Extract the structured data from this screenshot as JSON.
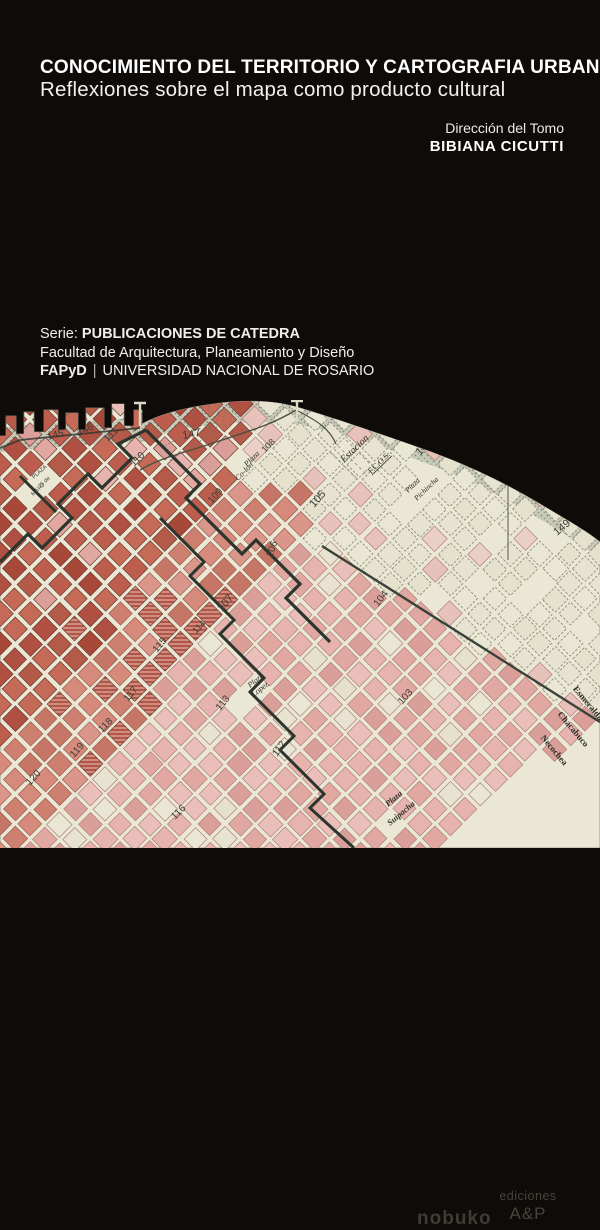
{
  "cover": {
    "title": "CONOCIMIENTO DEL TERRITORIO Y CARTOGRAFIA URBANA",
    "subtitle": "Reflexiones sobre el mapa como producto cultural",
    "direction_label": "Dirección del Tomo",
    "director_name": "BIBIANA CICUTTI",
    "series_prefix": "Serie:",
    "series_name": "PUBLICACIONES DE CATEDRA",
    "faculty": "Facultad de Arquitectura, Planeamiento y Diseño",
    "institution_abbr": "FAPyD",
    "institution_sep": "|",
    "institution_name": "UNIVERSIDAD NACIONAL DE ROSARIO"
  },
  "publisher": {
    "name": "nobuko",
    "imprint_line1": "ediciones",
    "imprint_line2": "A&P"
  },
  "map": {
    "description": "historic cadastral plan of Rosario with river coastline, pink block grid and numbered sections",
    "palette": {
      "paper": "#ebe7d5",
      "coast_band": "#c7cab8",
      "coast_dots": "#68725f",
      "bold_line": "#2c352d",
      "label_ink": "#3c3c33",
      "serif_ink": "#2e2e27",
      "dark": [
        "#b05042",
        "#bd5d4e",
        "#a84838",
        "#c46a57",
        "#b45a48"
      ],
      "salmon": [
        "#cd7f70",
        "#d58a7b",
        "#c67666",
        "#da968a"
      ],
      "light": [
        "#e1a8a2",
        "#e6b3ae",
        "#db9f99",
        "#eabfb9"
      ],
      "pale_pink": [
        "#e9cfc6",
        "#e6c2ba"
      ],
      "cream": [
        "#e7e3d0",
        "#eae6d4",
        "#e5e1cd"
      ],
      "stroke_dark": "#6e3a30",
      "stroke_salmon": "#9c5c4e",
      "stroke_light": "#b07f78",
      "stroke_dashed": "#8f8d7c"
    },
    "labels": [
      {
        "t": "145",
        "x": 48,
        "y": 40,
        "r": -15,
        "s": 10
      },
      {
        "t": "146",
        "x": 79,
        "y": 36,
        "r": -26,
        "s": 10
      },
      {
        "t": "147",
        "x": 183,
        "y": 39,
        "r": -10,
        "s": 11
      },
      {
        "t": "148",
        "x": 420,
        "y": 56,
        "r": -47,
        "s": 11
      },
      {
        "t": "149",
        "x": 557,
        "y": 136,
        "r": -40,
        "s": 11
      },
      {
        "t": "111",
        "x": 108,
        "y": 42,
        "r": -45,
        "s": 10
      },
      {
        "t": "110",
        "x": 134,
        "y": 67,
        "r": -45,
        "s": 10
      },
      {
        "t": "109",
        "x": 212,
        "y": 104,
        "r": -48,
        "s": 10
      },
      {
        "t": "108",
        "x": 265,
        "y": 53,
        "r": -45,
        "s": 9
      },
      {
        "t": "Plaza",
        "x": 247,
        "y": 67,
        "r": -45,
        "s": 8,
        "f": "sf",
        "it": 1
      },
      {
        "t": "Co-lon",
        "x": 238,
        "y": 81,
        "r": -45,
        "s": 8,
        "f": "sf",
        "it": 1
      },
      {
        "t": "PLAZA",
        "x": 34,
        "y": 79,
        "r": -42,
        "s": 5.5
      },
      {
        "t": "25 de",
        "x": 40,
        "y": 88,
        "r": -42,
        "s": 5.5
      },
      {
        "t": "MAYO",
        "x": 33,
        "y": 96,
        "r": -42,
        "s": 5.5
      },
      {
        "t": "Estacion",
        "x": 344,
        "y": 63,
        "r": -44,
        "s": 10,
        "f": "sf",
        "it": 1
      },
      {
        "t": "F.C.O.S.",
        "x": 371,
        "y": 74,
        "r": -44,
        "s": 8,
        "f": "sf",
        "u": 1
      },
      {
        "t": "Plaza",
        "x": 408,
        "y": 93,
        "r": -44,
        "s": 7.5,
        "f": "sf",
        "it": 1
      },
      {
        "t": "Pichincha",
        "x": 417,
        "y": 101,
        "r": -44,
        "s": 7.5,
        "f": "sf",
        "it": 1
      },
      {
        "t": "105",
        "x": 314,
        "y": 108,
        "r": -48,
        "s": 11
      },
      {
        "t": "106",
        "x": 272,
        "y": 158,
        "r": -70,
        "s": 10
      },
      {
        "t": "107",
        "x": 222,
        "y": 212,
        "r": -50,
        "s": 11
      },
      {
        "t": "114",
        "x": 196,
        "y": 234,
        "r": -45,
        "s": 9
      },
      {
        "t": "115",
        "x": 157,
        "y": 253,
        "r": -50,
        "s": 10
      },
      {
        "t": "113",
        "x": 220,
        "y": 311,
        "r": -50,
        "s": 10
      },
      {
        "t": "Plaza",
        "x": 250,
        "y": 288,
        "r": -38,
        "s": 8,
        "f": "sf",
        "it": 1
      },
      {
        "t": "Lopez",
        "x": 254,
        "y": 297,
        "r": -38,
        "s": 8,
        "f": "sf",
        "it": 1
      },
      {
        "t": "117",
        "x": 128,
        "y": 302,
        "r": -50,
        "s": 10
      },
      {
        "t": "118",
        "x": 102,
        "y": 333,
        "r": -45,
        "s": 10
      },
      {
        "t": "119",
        "x": 74,
        "y": 358,
        "r": -48,
        "s": 10
      },
      {
        "t": "120",
        "x": 30,
        "y": 386,
        "r": -48,
        "s": 10
      },
      {
        "t": "116",
        "x": 175,
        "y": 420,
        "r": -45,
        "s": 10
      },
      {
        "t": "112",
        "x": 277,
        "y": 357,
        "r": -55,
        "s": 10
      },
      {
        "t": "104",
        "x": 378,
        "y": 207,
        "r": -52,
        "s": 10
      },
      {
        "t": "103",
        "x": 402,
        "y": 305,
        "r": -48,
        "s": 10
      },
      {
        "t": "Esmeralda",
        "x": 586,
        "y": 305,
        "r": 50,
        "s": 9,
        "f": "sf",
        "w": 700,
        "a": "middle"
      },
      {
        "t": "Chacabuco",
        "x": 571,
        "y": 331,
        "r": 50,
        "s": 9,
        "f": "sf",
        "w": 700,
        "a": "middle"
      },
      {
        "t": "Necochea",
        "x": 552,
        "y": 352,
        "r": 50,
        "s": 9,
        "f": "sf",
        "w": 700,
        "a": "middle"
      },
      {
        "t": "Plaza",
        "x": 388,
        "y": 407,
        "r": -40,
        "s": 8.5,
        "f": "sf",
        "it": 1,
        "w": 700
      },
      {
        "t": "Suipacha",
        "x": 390,
        "y": 426,
        "r": -40,
        "s": 8.5,
        "f": "sf",
        "it": 1,
        "w": 700
      }
    ]
  }
}
